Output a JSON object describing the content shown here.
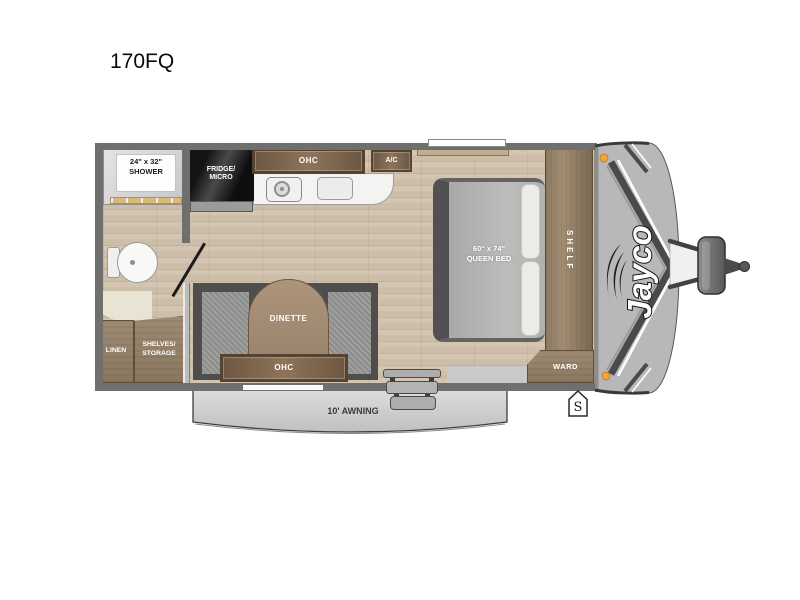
{
  "title": "170FQ",
  "plan": {
    "shower_size": "24\" x 32\"",
    "shower": "SHOWER",
    "fridge1": "FRIDGE/",
    "fridge2": "MICRO",
    "ohc": "OHC",
    "ac": "A/C",
    "bed_size": "60\" x 74\"",
    "bed": "QUEEN BED",
    "shelf": "SHELF",
    "ward": "WARD",
    "dinette": "DINETTE",
    "dinette_ohc": "OHC",
    "linen": "LINEN",
    "shelves1": "SHELVES/",
    "shelves2": "STORAGE",
    "awning": "10' AWNING",
    "brand": "Jayco",
    "marker": "S"
  },
  "colors": {
    "wall": "#6f6f6d",
    "floor": "#ccbea8",
    "cabinet_wood": "#8d745a",
    "front_cap": "#b8b8ba",
    "clearance_light": "#f4a43c"
  }
}
